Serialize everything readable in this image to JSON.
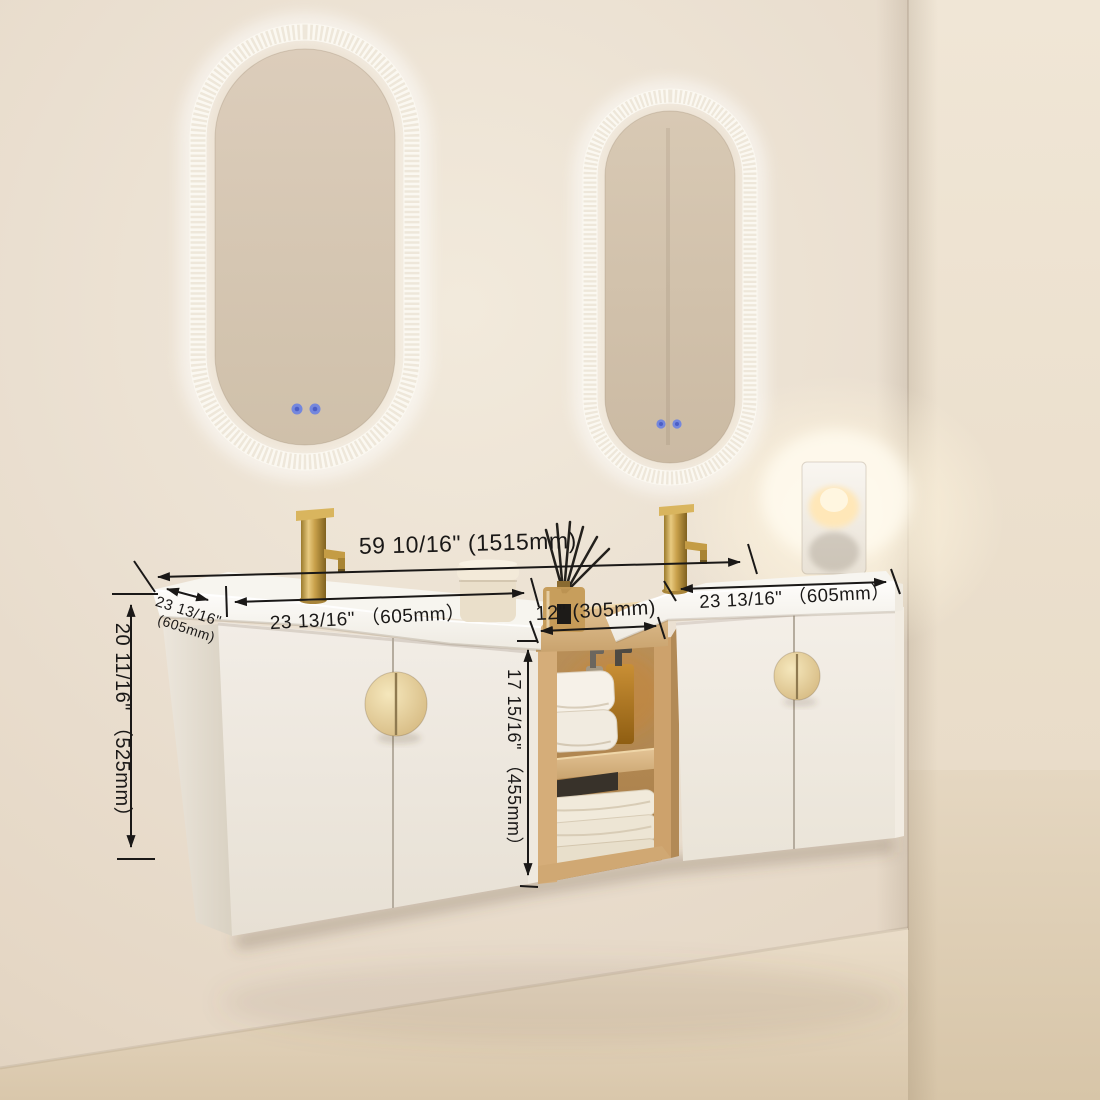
{
  "annotations": {
    "overall_width": "59 10/16\" (1515mm)",
    "left_cabinet_width": "23 13/16\" （605mm）",
    "middle_shelf_width": "12\" (305mm)",
    "right_cabinet_width": "23 13/16\" （605mm）",
    "side_depth": {
      "line1": "23 13/16\"",
      "line2": "(605mm)"
    },
    "overall_height": "20 11/16\" （525mm）",
    "shelf_opening_height": "17 15/16\" （455mm）"
  },
  "palette": {
    "wall": "#eadfd0",
    "floor": "#e0d0b8",
    "countertop": "#fbfaf7",
    "cabinet": "#f0ebe3",
    "wood": "#dcba8a",
    "gold_faucet": "#c9a14b",
    "annotation_ink": "#1a1817",
    "led_touch_button": "#7487dd",
    "lamp_glow": "#ffe7b8"
  }
}
